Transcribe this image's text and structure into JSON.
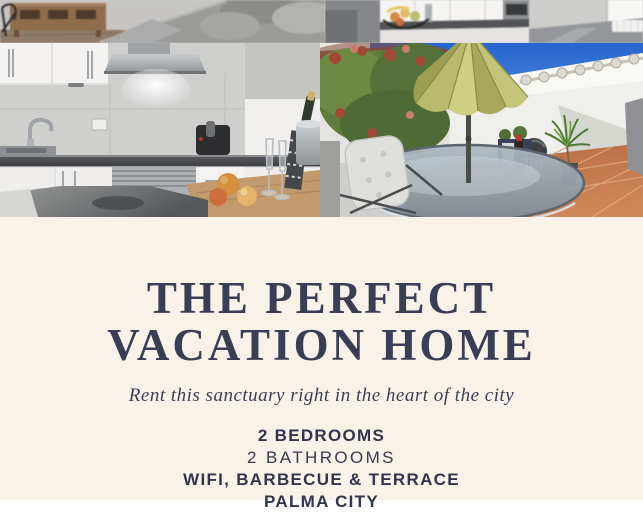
{
  "poster": {
    "title": {
      "line1": "THE PERFECT",
      "line2": "VACATION HOME"
    },
    "subtitle": "Rent this sanctuary right in the heart of the city",
    "features": [
      "2 BEDROOMS",
      "2 BATHROOMS",
      "WIFI, BARBECUE & TERRACE",
      "PALMA CITY"
    ],
    "colors": {
      "background": "#f9f2e8",
      "title_text": "#3a3e55",
      "body_text": "#31344a",
      "sky_blue": "#2e6fd6",
      "umbrella_olive": "#cdd083",
      "terracotta_floor": "#c07a4d"
    },
    "collage_photos": [
      "living-room-sofa",
      "kitchen-with-fruit-basket",
      "kitchen-closeup",
      "roof-terrace"
    ]
  }
}
